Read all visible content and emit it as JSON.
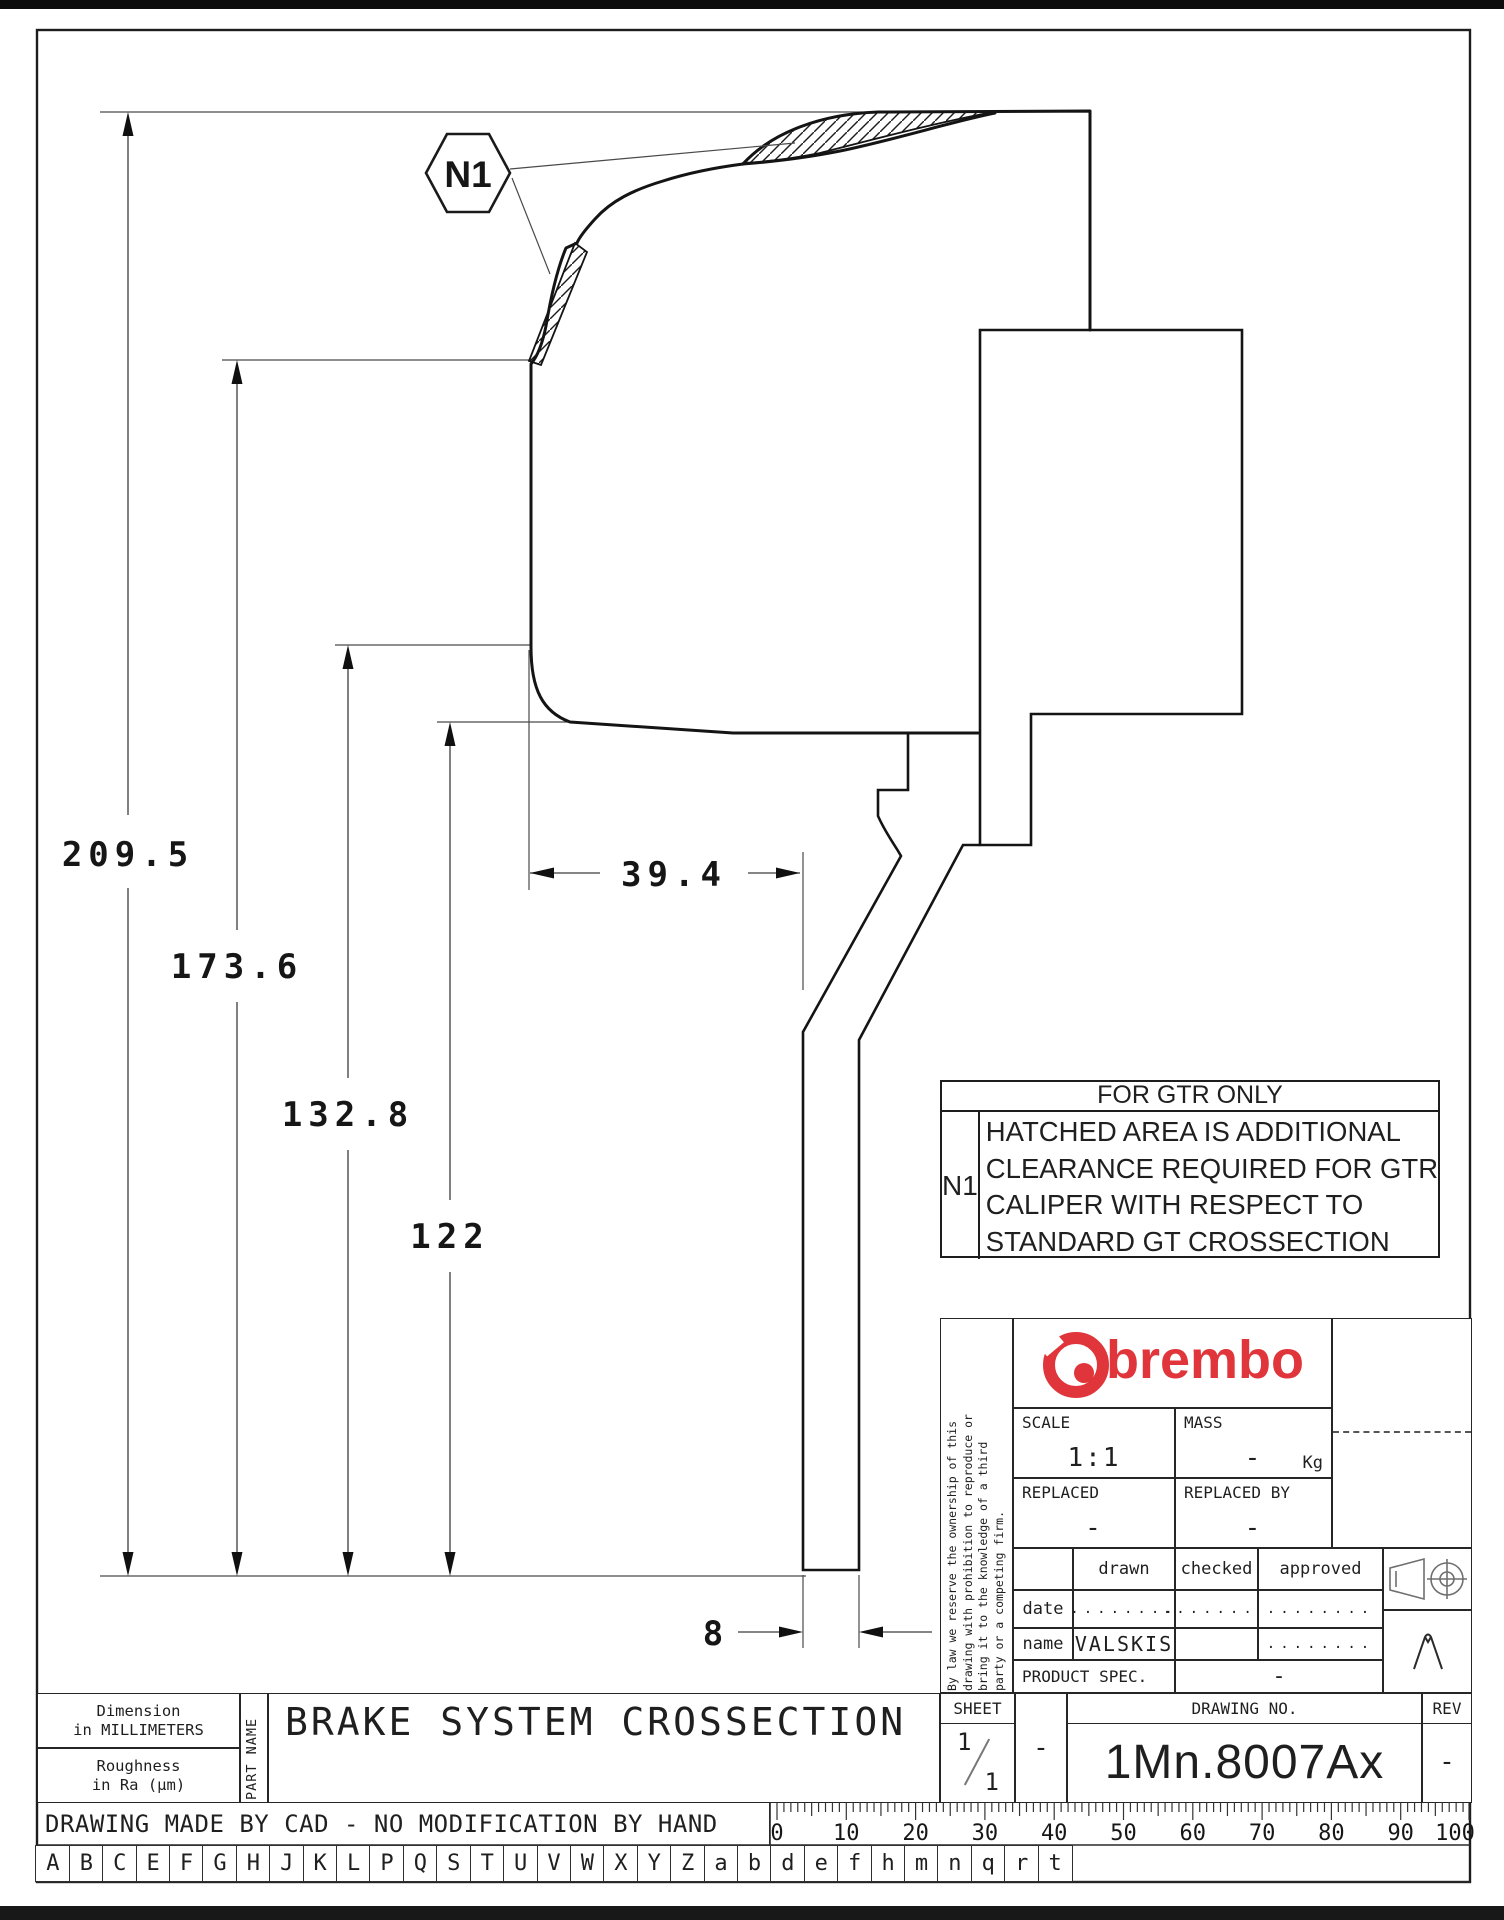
{
  "colors": {
    "accent_red": "#e0353a",
    "line": "#1f1f1f"
  },
  "drawing": {
    "hexagon_label": "N1",
    "dim_overall": "209.5",
    "dim_hat_height": "173.6",
    "dim_body_height": "132.8",
    "dim_inner_height": "122",
    "dim_body_width": "39.4",
    "dim_disc_thickness": "8"
  },
  "note_box": {
    "title": "FOR GTR ONLY",
    "ref": "N1",
    "lines": [
      "HATCHED AREA IS ADDITIONAL",
      "CLEARANCE REQUIRED FOR GTR",
      "CALIPER WITH RESPECT TO",
      "STANDARD GT CROSSECTION"
    ]
  },
  "title_block": {
    "brand": "brembo",
    "disclaimer_lines": [
      "By law we reserve the ownership of this",
      "drawing with prohibition to reproduce or",
      "bring it to the knowledge of a third",
      "party or a competing firm."
    ],
    "scale_label": "SCALE",
    "scale_value": "1:1",
    "mass_label": "MASS",
    "mass_value": "-",
    "mass_unit": "Kg",
    "replaced_label": "REPLACED",
    "replaced_value": "-",
    "replaced_by_label": "REPLACED BY",
    "replaced_by_value": "-",
    "drawn_label": "drawn",
    "checked_label": "checked",
    "approved_label": "approved",
    "date_label": "date",
    "name_label": "name",
    "name_value": "VALSKIS",
    "dots": "........",
    "product_spec_label": "PRODUCT SPEC.",
    "product_spec_value": "-",
    "sheet_label": "SHEET",
    "sheet_num": "1",
    "sheet_den": "1",
    "sheet_dash": "-",
    "drawing_no_label": "DRAWING NO.",
    "drawing_no_value": "1Mn.8007Ax",
    "rev_label": "REV",
    "rev_value": "-"
  },
  "part_strip": {
    "dim_line1": "Dimension",
    "dim_line2": "in MILLIMETERS",
    "rough_line1": "Roughness",
    "rough_line2": "in Ra (µm)",
    "part_name_label": "PART NAME",
    "part_name": "BRAKE SYSTEM CROSSECTION"
  },
  "footer": {
    "cad_note": "DRAWING MADE BY CAD - NO MODIFICATION BY HAND",
    "letters": [
      "A",
      "B",
      "C",
      "E",
      "F",
      "G",
      "H",
      "J",
      "K",
      "L",
      "P",
      "Q",
      "S",
      "T",
      "U",
      "V",
      "W",
      "X",
      "Y",
      "Z",
      "a",
      "b",
      "d",
      "e",
      "f",
      "h",
      "m",
      "n",
      "q",
      "r",
      "t"
    ],
    "ruler_numbers": [
      "0",
      "10",
      "20",
      "30",
      "40",
      "50",
      "60",
      "70",
      "80",
      "90",
      "100"
    ]
  }
}
